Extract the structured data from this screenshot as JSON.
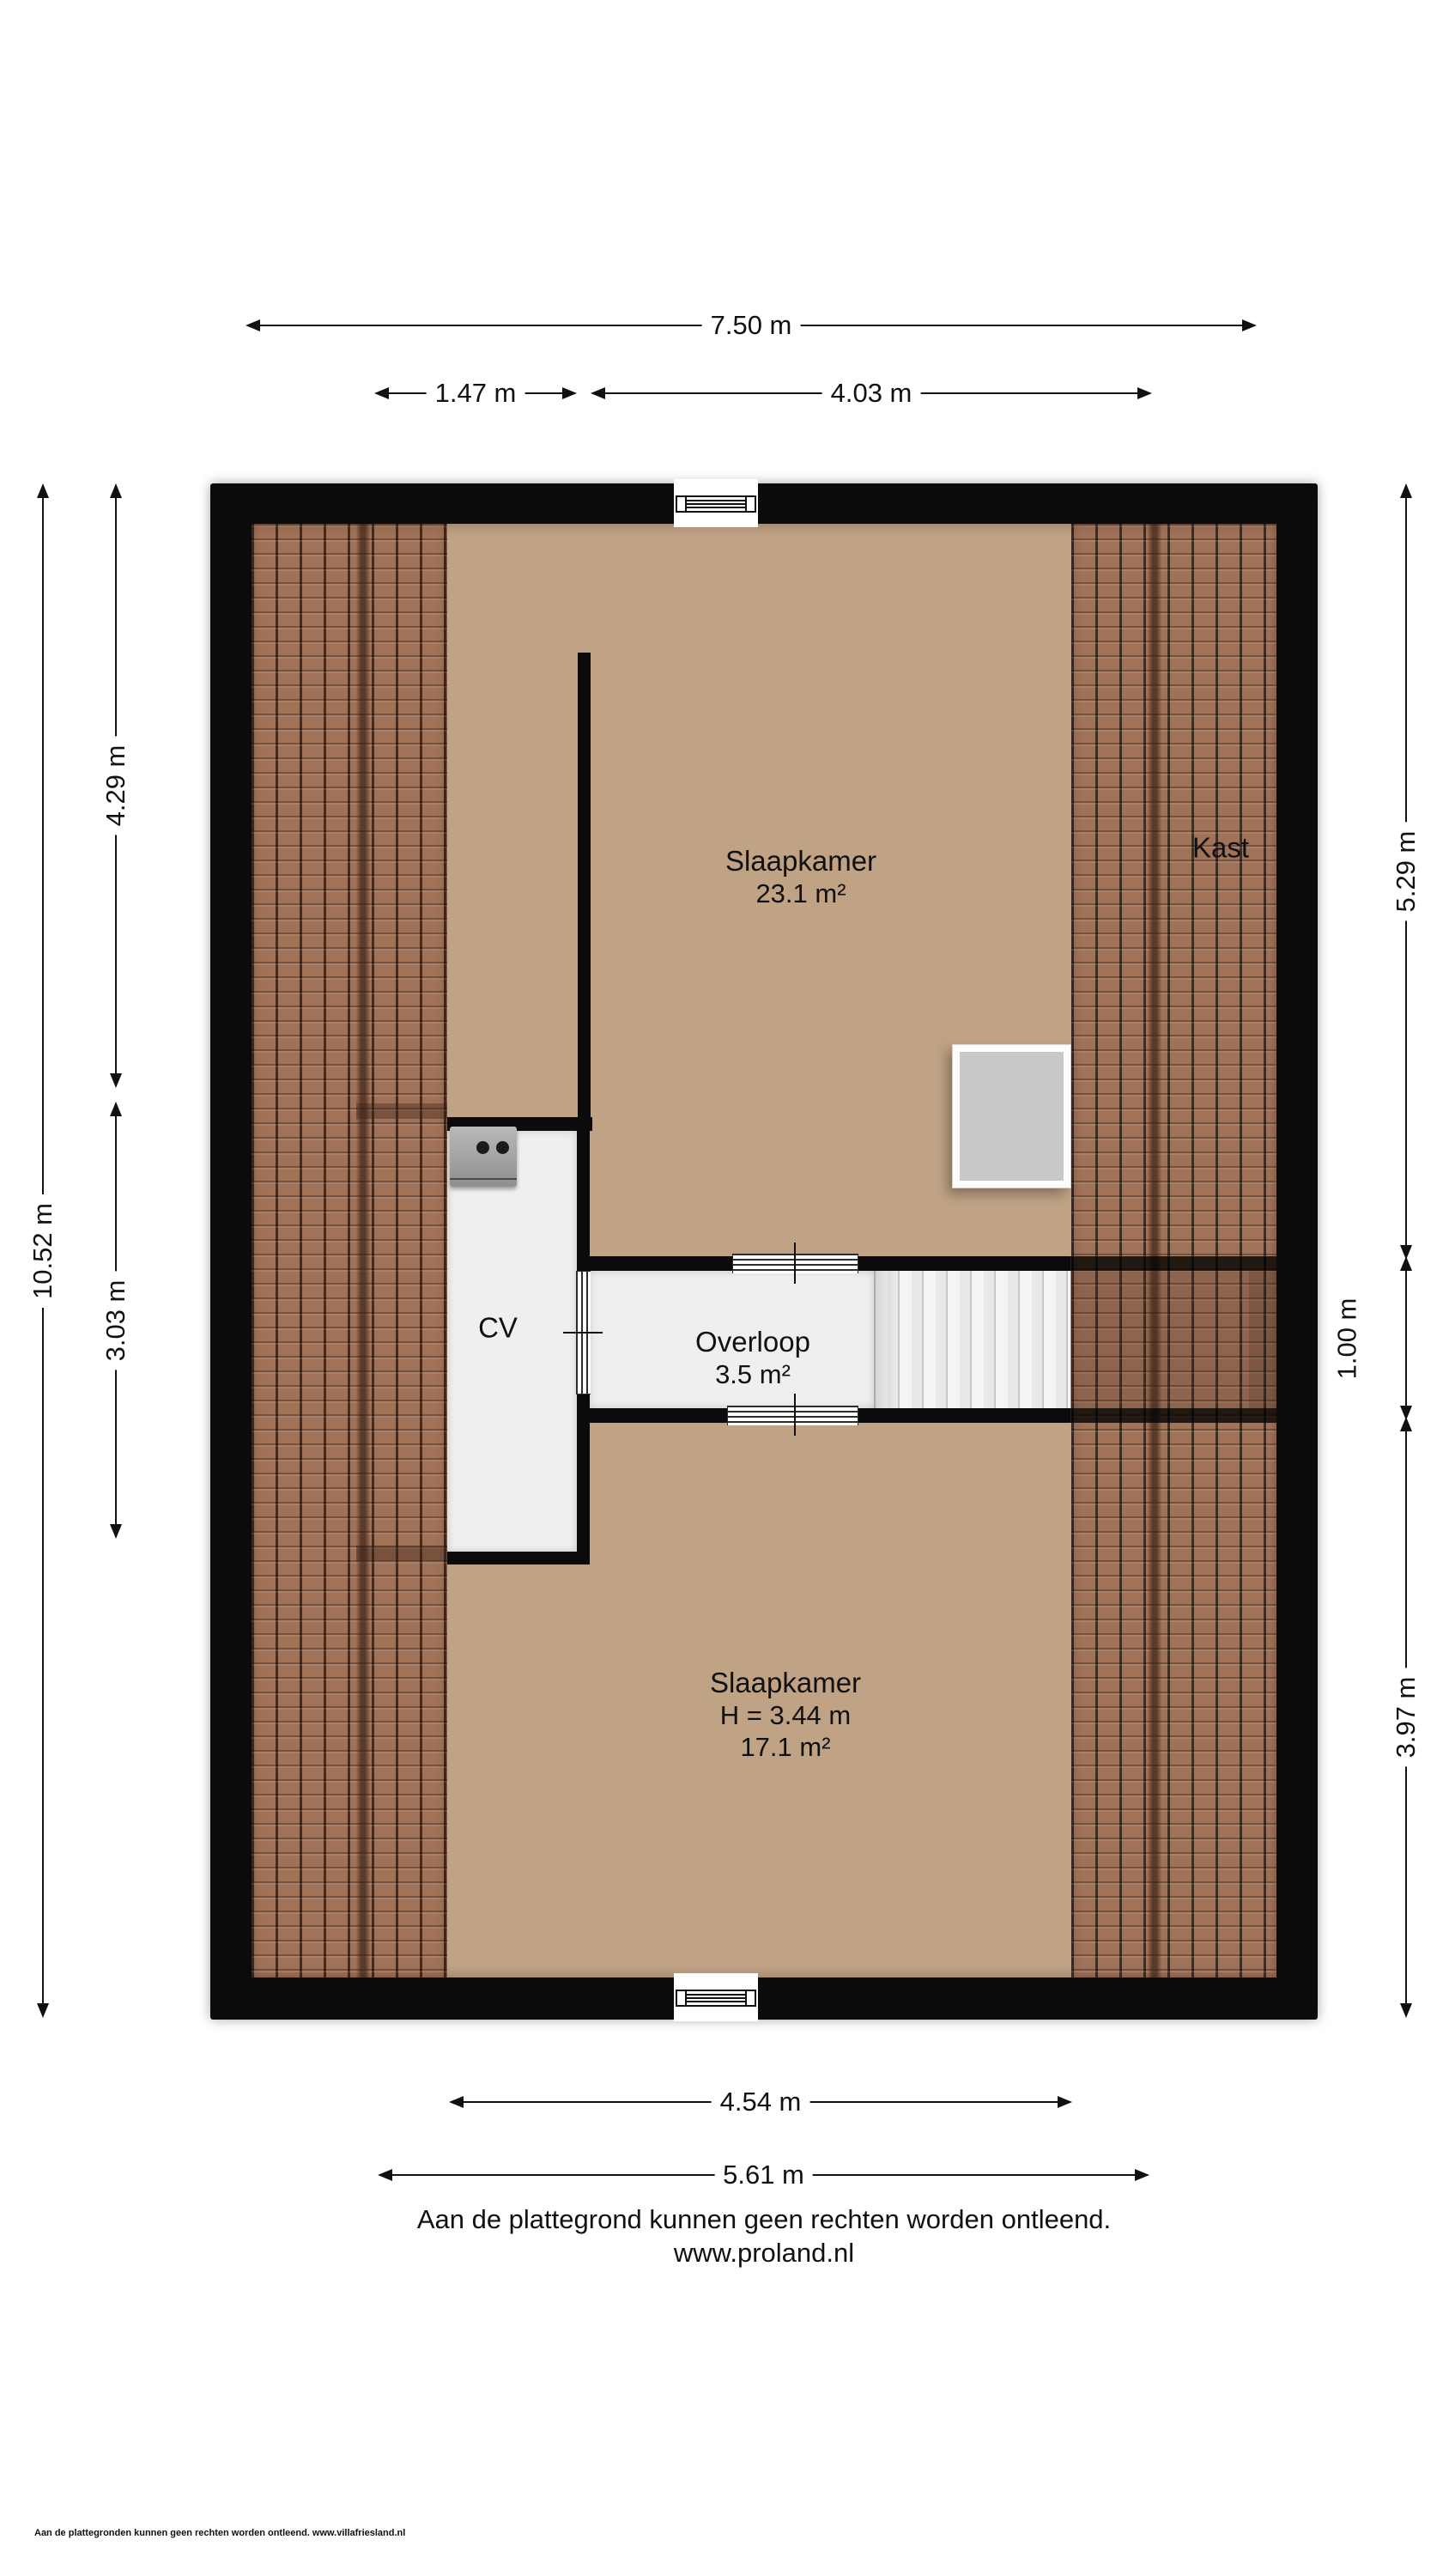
{
  "rooms": {
    "bedroom_top": {
      "name": "Slaapkamer",
      "area": "23.1 m²"
    },
    "closet": {
      "name": "Kast"
    },
    "cv": {
      "name": "CV"
    },
    "landing": {
      "name": "Overloop",
      "area": "3.5 m²"
    },
    "bedroom_bottom": {
      "name": "Slaapkamer",
      "height": "H = 3.44 m",
      "area": "17.1 m²"
    }
  },
  "dimensions": {
    "top_total": "7.50 m",
    "top_left": "1.47 m",
    "top_right": "4.03 m",
    "left_total": "10.52 m",
    "left_upper": "4.29 m",
    "left_lower": "3.03 m",
    "right_upper": "5.29 m",
    "right_middle": "1.00 m",
    "right_lower": "3.97 m",
    "bottom_inner": "4.54 m",
    "bottom_outer": "5.61 m"
  },
  "footer": {
    "disclaimer": "Aan de plattegrond kunnen geen rechten worden ontleend.",
    "website": "www.proland.nl"
  },
  "micro_footer": "Aan de plattegronden kunnen geen rechten worden ontleend. www.villafriesland.nl",
  "colors": {
    "wall": "#0b0b0b",
    "floor_tan": "#c0a285",
    "floor_white": "#efefef",
    "roof_tile": "#a07258",
    "skylight": "#c9c9c7"
  }
}
